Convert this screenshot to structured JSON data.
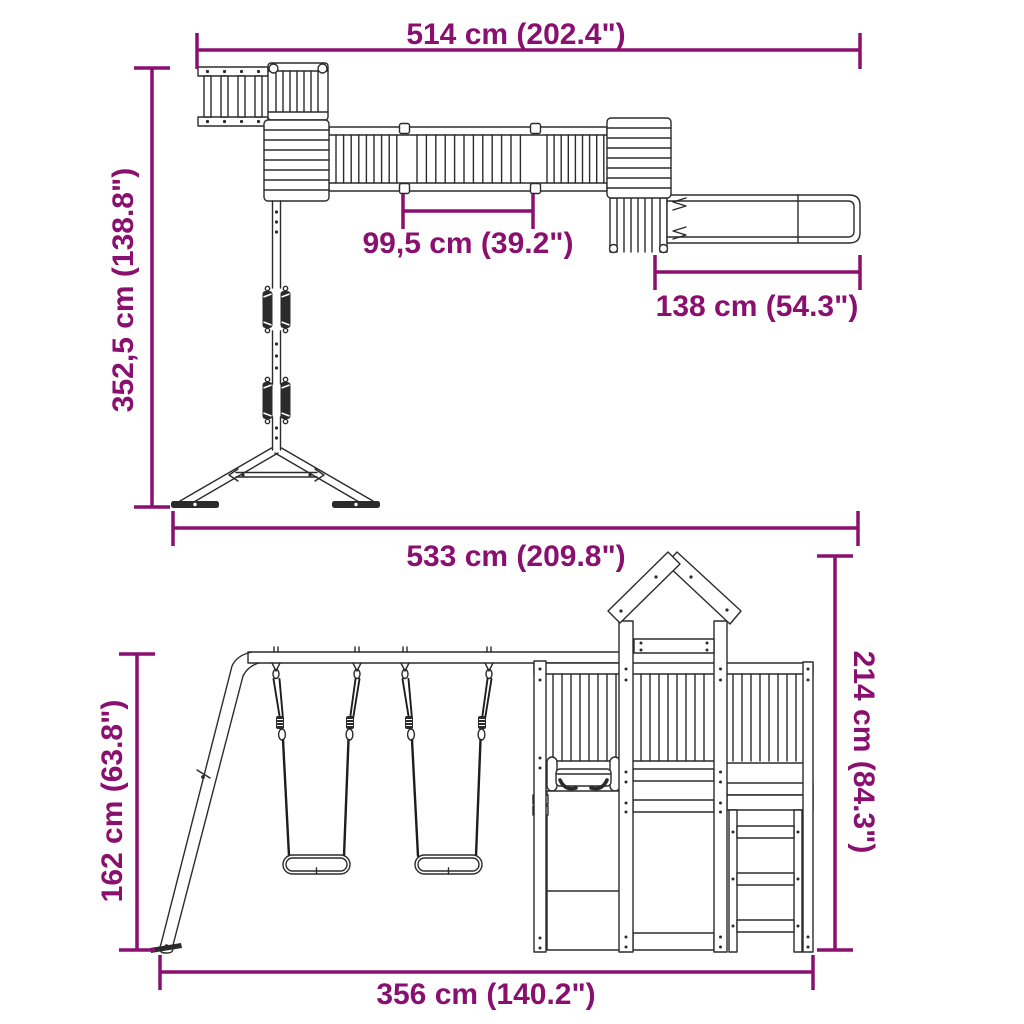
{
  "meta": {
    "accent_color": "#8A1070",
    "line_color": "#2b2b2b",
    "background": "#ffffff"
  },
  "dims": {
    "top_width": "514 cm (202.4\")",
    "top_depth": "352,5 cm (138.8\")",
    "bridge_width": "99,5 cm (39.2\")",
    "slide_length": "138 cm (54.3\")",
    "overall_width": "533 cm (209.8\")",
    "tower_height": "214 cm (84.3\")",
    "swing_height": "162 cm (63.8\")",
    "base_width": "356 cm (140.2\")"
  }
}
